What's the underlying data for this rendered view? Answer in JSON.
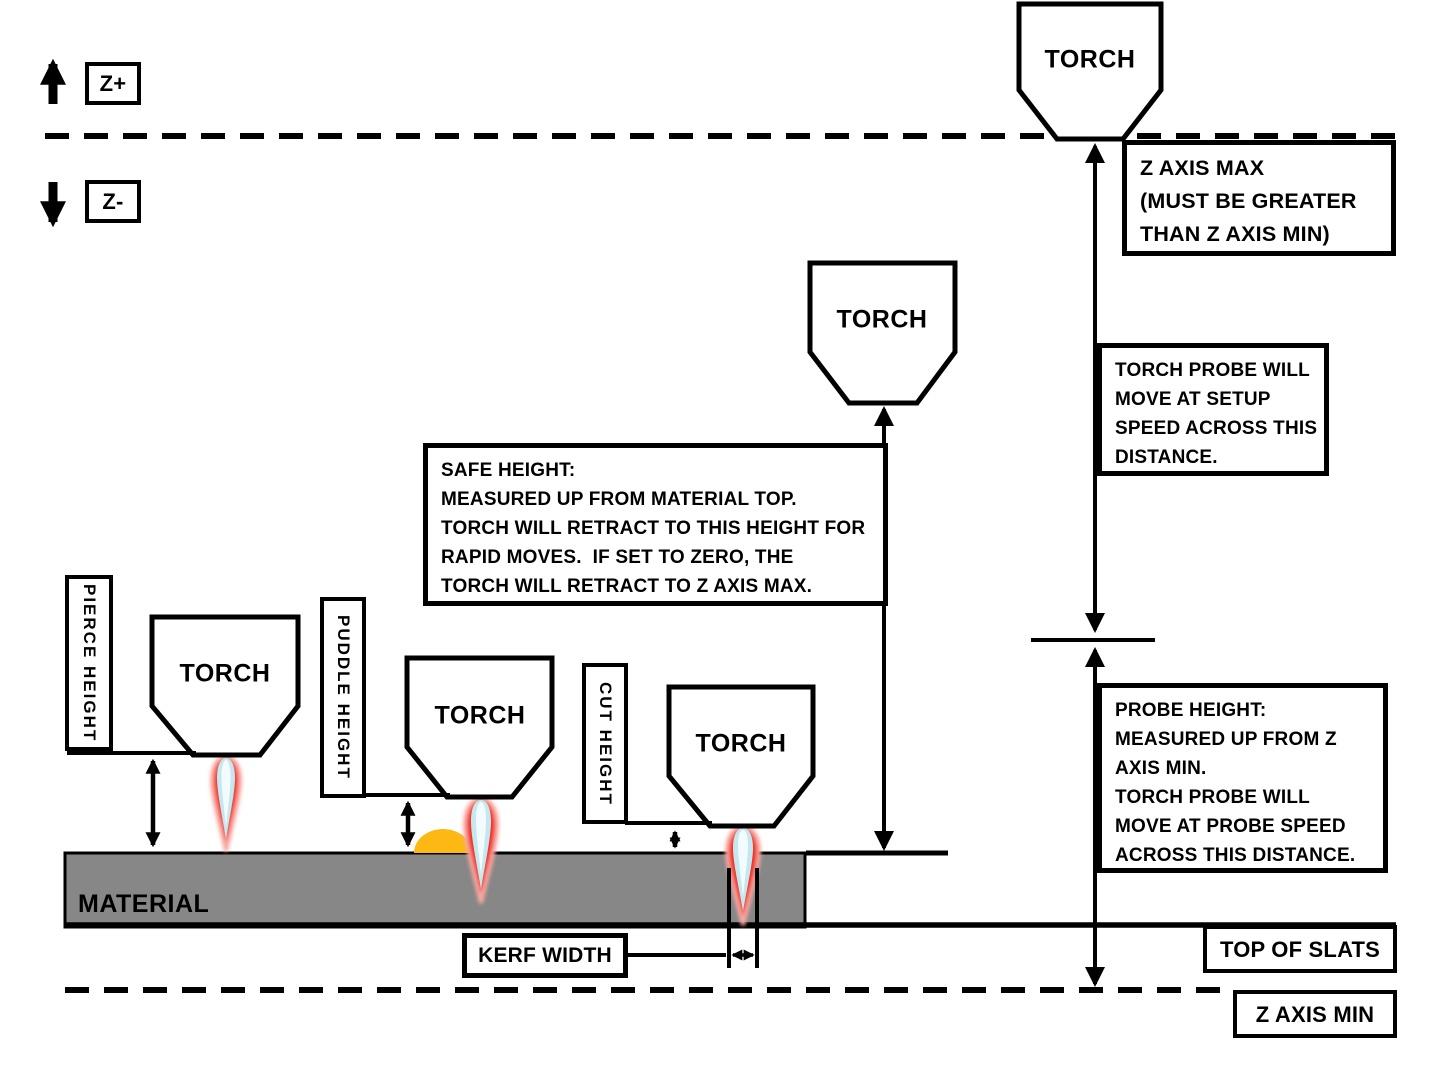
{
  "colors": {
    "background": "#ffffff",
    "line_black": "#000000",
    "material_gray": "#878787",
    "puddle_orange": "#FDB813",
    "flame_red": "#EE3124",
    "flame_glow": "#F9A8A2",
    "flame_blue": "#C5E8F0",
    "flame_core": "#F2FBFD"
  },
  "labels": {
    "torch": "TORCH",
    "material": "MATERIAL",
    "z_plus": "Z+",
    "z_minus": "Z-",
    "top_of_slats": "TOP OF SLATS",
    "z_axis_min": "Z AXIS MIN",
    "kerf_width": "KERF WIDTH",
    "pierce_height": "PIERCE HEIGHT",
    "puddle_height": "PUDDLE HEIGHT",
    "cut_height": "CUT HEIGHT"
  },
  "notes": {
    "z_axis_max": "Z AXIS MAX\n(MUST BE GREATER\nTHAN Z AXIS MIN)",
    "torch_probe": "TORCH PROBE WILL\nMOVE AT SETUP\nSPEED ACROSS THIS\nDISTANCE.",
    "safe_height": "SAFE HEIGHT:\nMEASURED UP FROM MATERIAL TOP.\nTORCH WILL RETRACT TO THIS HEIGHT FOR\nRAPID MOVES.  IF SET TO ZERO, THE\nTORCH WILL RETRACT TO Z AXIS MAX.",
    "probe_height": "PROBE HEIGHT:\nMEASURED UP FROM Z\nAXIS MIN.\nTORCH PROBE WILL\nMOVE AT PROBE SPEED\nACROSS THIS DISTANCE."
  }
}
